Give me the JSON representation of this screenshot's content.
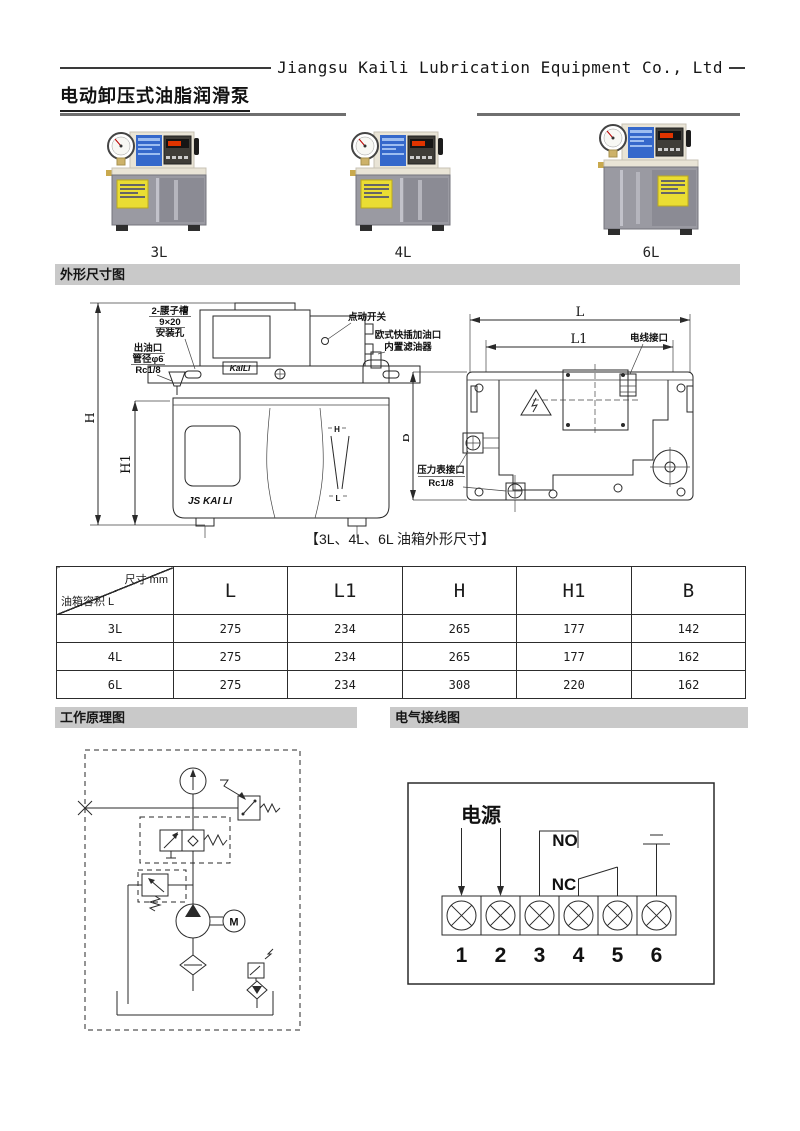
{
  "header": {
    "company": "Jiangsu Kaili Lubrication Equipment Co., Ltd",
    "title": "电动卸压式油脂润滑泵"
  },
  "products": [
    {
      "label": "3L"
    },
    {
      "label": "4L"
    },
    {
      "label": "6L"
    }
  ],
  "sections": {
    "outline": "外形尺寸图",
    "principle": "工作原理图",
    "wiring": "电气接线图"
  },
  "outline_drawing": {
    "caption": "【3L、4L、6L 油箱外形尺寸】",
    "front_view": {
      "mounting_hole_line1": "2-腰子槽",
      "mounting_hole_line2": "9×20",
      "mounting_hole_line3": "安装孔",
      "oil_outlet_line1": "出油口",
      "oil_outlet_line2": "管径φ6",
      "oil_outlet_line3": "Rc1/8",
      "jog_switch": "点动开关",
      "filler_line1": "欧式快插加油口",
      "filler_line2": "内置滤油器",
      "brand_plate": "KaiLi",
      "tank_brand": "JS KAI LI",
      "level_high": "H",
      "level_low": "L",
      "dim_h": "H",
      "dim_h1": "H1"
    },
    "top_view": {
      "dim_l": "L",
      "dim_l1": "L1",
      "dim_b": "B",
      "wire_port": "电线接口",
      "gauge_port_line1": "压力表接口",
      "gauge_port_line2": "Rc1/8"
    }
  },
  "dimensions_table": {
    "corner_top": "尺寸 mm",
    "corner_bottom": "油箱容积 L",
    "columns": [
      "L",
      "L1",
      "H",
      "H1",
      "B"
    ],
    "rows": [
      {
        "label": "3L",
        "values": [
          "275",
          "234",
          "265",
          "177",
          "142"
        ]
      },
      {
        "label": "4L",
        "values": [
          "275",
          "234",
          "265",
          "177",
          "162"
        ]
      },
      {
        "label": "6L",
        "values": [
          "275",
          "234",
          "308",
          "220",
          "162"
        ]
      }
    ]
  },
  "principle_diagram": {
    "motor_label": "M"
  },
  "wiring_diagram": {
    "power_label": "电源",
    "no_label": "NO",
    "nc_label": "NC",
    "terminals": [
      "1",
      "2",
      "3",
      "4",
      "5",
      "6"
    ]
  },
  "colors": {
    "section_bar_bg": "#c9c9c9",
    "pump_body": "#e9e4d6",
    "pump_label_blue": "#3568cb",
    "display_red": "#e03400",
    "tank_gray": "#9a9aa2",
    "warning_yellow": "#eadd33"
  }
}
